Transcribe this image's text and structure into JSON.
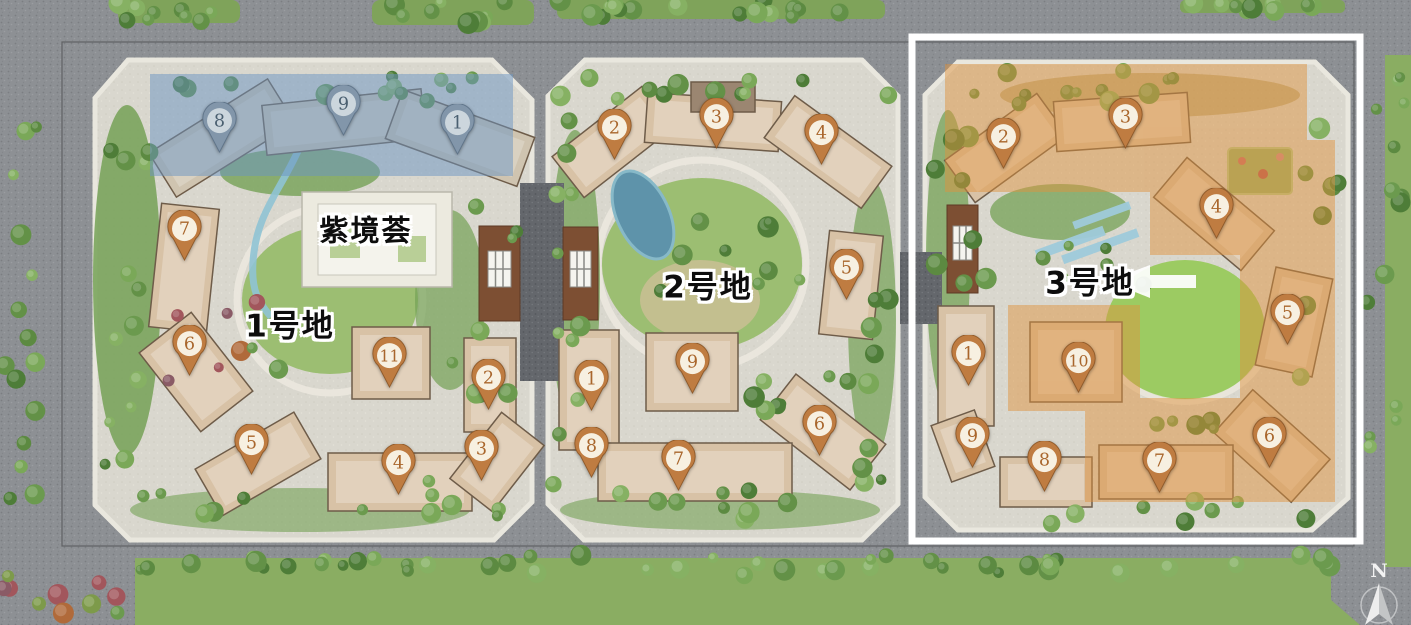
{
  "title": "residential-master-plan",
  "highlighted_plot": "3号地",
  "labels": [
    {
      "id": "plot-1-name",
      "text": "1号地",
      "x": 290,
      "y": 327,
      "size": 31
    },
    {
      "id": "plot-2-name",
      "text": "2号地",
      "x": 708,
      "y": 288,
      "size": 31
    },
    {
      "id": "plot-3-name",
      "text": "3号地",
      "x": 1090,
      "y": 284,
      "size": 31
    },
    {
      "id": "clubhouse-name",
      "text": "紫境荟",
      "x": 366,
      "y": 231,
      "size": 29
    }
  ],
  "markers": [
    {
      "plot": "1号地",
      "num": "8",
      "x": 219,
      "y": 120,
      "style": "blue"
    },
    {
      "plot": "1号地",
      "num": "9",
      "x": 343,
      "y": 103,
      "style": "blue"
    },
    {
      "plot": "1号地",
      "num": "1",
      "x": 457,
      "y": 122,
      "style": "blue"
    },
    {
      "plot": "1号地",
      "num": "7",
      "x": 184,
      "y": 228,
      "style": "tan"
    },
    {
      "plot": "1号地",
      "num": "6",
      "x": 189,
      "y": 343,
      "style": "tan"
    },
    {
      "plot": "1号地",
      "num": "11",
      "x": 389,
      "y": 355,
      "style": "tan"
    },
    {
      "plot": "1号地",
      "num": "2",
      "x": 488,
      "y": 377,
      "style": "tan"
    },
    {
      "plot": "1号地",
      "num": "5",
      "x": 251,
      "y": 442,
      "style": "tan"
    },
    {
      "plot": "1号地",
      "num": "4",
      "x": 398,
      "y": 462,
      "style": "tan"
    },
    {
      "plot": "1号地",
      "num": "3",
      "x": 481,
      "y": 448,
      "style": "tan"
    },
    {
      "plot": "2号地",
      "num": "2",
      "x": 614,
      "y": 127,
      "style": "tan"
    },
    {
      "plot": "2号地",
      "num": "3",
      "x": 716,
      "y": 116,
      "style": "tan"
    },
    {
      "plot": "2号地",
      "num": "4",
      "x": 821,
      "y": 132,
      "style": "tan"
    },
    {
      "plot": "2号地",
      "num": "5",
      "x": 846,
      "y": 267,
      "style": "tan"
    },
    {
      "plot": "2号地",
      "num": "1",
      "x": 591,
      "y": 378,
      "style": "tan"
    },
    {
      "plot": "2号地",
      "num": "9",
      "x": 692,
      "y": 361,
      "style": "tan"
    },
    {
      "plot": "2号地",
      "num": "6",
      "x": 819,
      "y": 423,
      "style": "tan"
    },
    {
      "plot": "2号地",
      "num": "8",
      "x": 591,
      "y": 445,
      "style": "tan"
    },
    {
      "plot": "2号地",
      "num": "7",
      "x": 678,
      "y": 458,
      "style": "tan"
    },
    {
      "plot": "3号地",
      "num": "2",
      "x": 1003,
      "y": 136,
      "style": "tan"
    },
    {
      "plot": "3号地",
      "num": "3",
      "x": 1125,
      "y": 116,
      "style": "tan"
    },
    {
      "plot": "3号地",
      "num": "4",
      "x": 1216,
      "y": 206,
      "style": "tan"
    },
    {
      "plot": "3号地",
      "num": "5",
      "x": 1287,
      "y": 312,
      "style": "tan"
    },
    {
      "plot": "3号地",
      "num": "1",
      "x": 968,
      "y": 353,
      "style": "tan"
    },
    {
      "plot": "3号地",
      "num": "10",
      "x": 1078,
      "y": 360,
      "style": "tan"
    },
    {
      "plot": "3号地",
      "num": "9",
      "x": 972,
      "y": 435,
      "style": "tan"
    },
    {
      "plot": "3号地",
      "num": "8",
      "x": 1044,
      "y": 459,
      "style": "tan"
    },
    {
      "plot": "3号地",
      "num": "7",
      "x": 1159,
      "y": 460,
      "style": "tan"
    },
    {
      "plot": "3号地",
      "num": "6",
      "x": 1269,
      "y": 435,
      "style": "tan"
    }
  ],
  "compass": {
    "label": "N"
  },
  "colors": {
    "road": "#8d9094",
    "plot_paving": "#d9d7ce",
    "lawn": "#8aad62",
    "building_tan": "#d8c2a6",
    "building_outline": "#6e5c49",
    "blue_overlay": "#6a93c2",
    "orange_overlay": "#e0923c",
    "highlight_border": "#ffffff",
    "gate_brown": "#7d4f33",
    "water": "#5e93aa",
    "pin_tan_body": "#bf7c41",
    "pin_tan_face": "#f7f0e1",
    "pin_tan_num": "#a9662c",
    "pin_blue_body": "#8296aa",
    "pin_blue_face": "#ccd6dd",
    "pin_blue_num": "#4a5f70"
  }
}
